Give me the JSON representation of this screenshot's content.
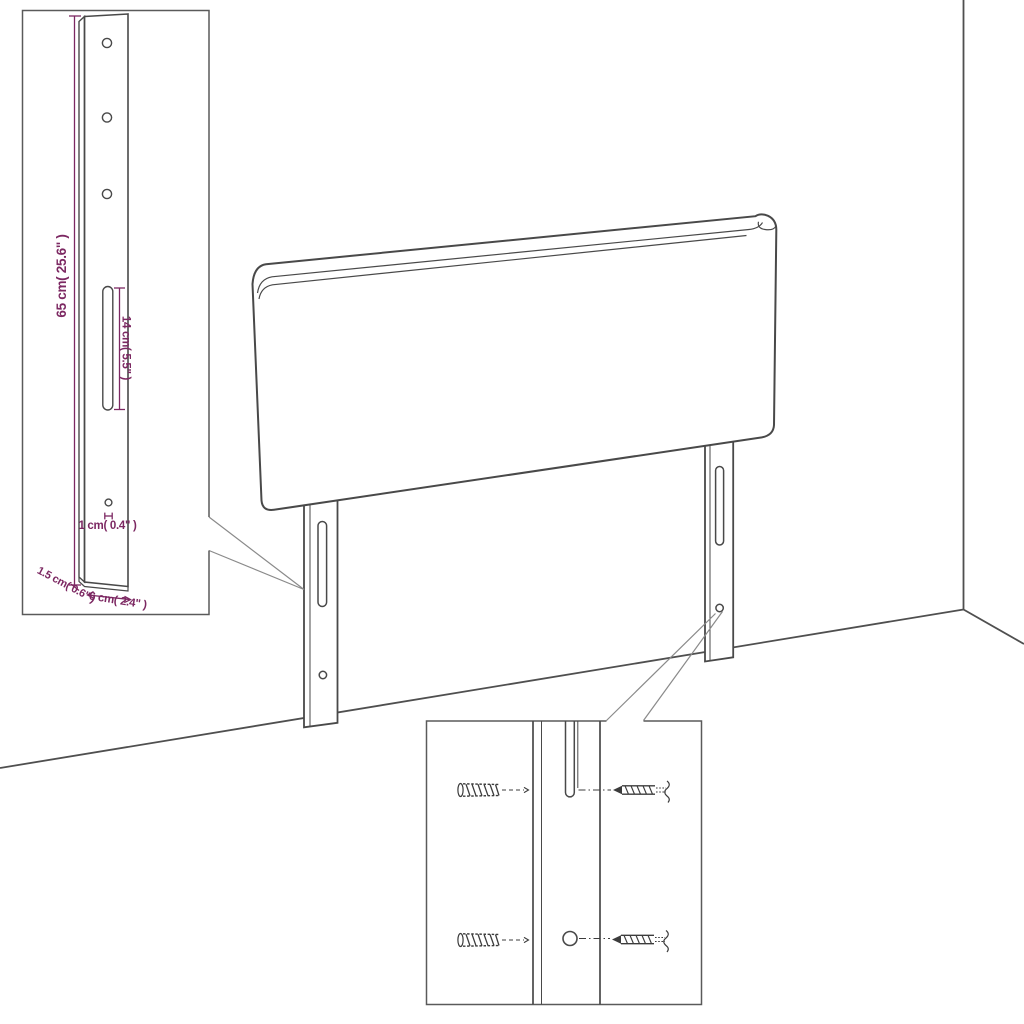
{
  "diagram": {
    "labels": {
      "leg_height": "65 cm( 25.6\" )",
      "slot_length": "14 cm( 5.5\" )",
      "hole_diameter": "1 cm( 0.4\" )",
      "leg_depth": "1.5 cm( 0.6\" )",
      "leg_width": "6 cm( 2.4\" )"
    },
    "colors": {
      "line": "#4a4a4a",
      "dimension_text": "#7c2862",
      "background": "#ffffff"
    }
  }
}
